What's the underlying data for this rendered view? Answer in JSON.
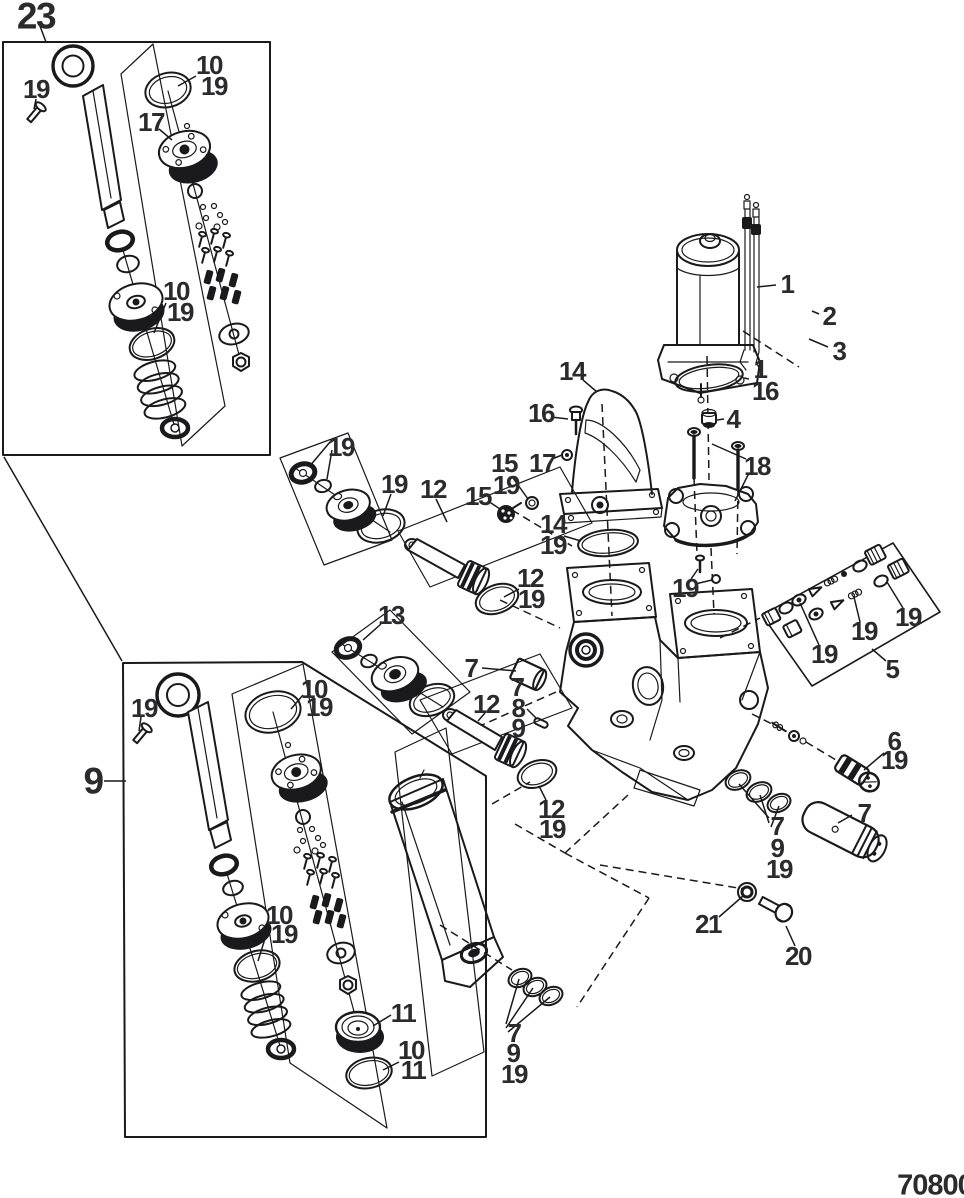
{
  "page": {
    "code": "70800",
    "type": "exploded-parts-diagram"
  },
  "colors": {
    "line": "#1a1a1c",
    "label": "#2b2b2d",
    "background": "#ffffff"
  },
  "callouts": [
    {
      "label": "23",
      "x": 36,
      "y": 16,
      "size": "lg"
    },
    {
      "label": "19",
      "x": 36,
      "y": 89,
      "size": "n"
    },
    {
      "label": "10",
      "x": 209,
      "y": 65,
      "size": "n"
    },
    {
      "label": "19",
      "x": 214,
      "y": 86,
      "size": "n"
    },
    {
      "label": "17",
      "x": 151,
      "y": 122,
      "size": "n"
    },
    {
      "label": "10",
      "x": 176,
      "y": 291,
      "size": "n"
    },
    {
      "label": "19",
      "x": 180,
      "y": 312,
      "size": "n"
    },
    {
      "label": "19",
      "x": 341,
      "y": 447,
      "size": "n"
    },
    {
      "label": "19",
      "x": 394,
      "y": 484,
      "size": "n"
    },
    {
      "label": "12",
      "x": 433,
      "y": 489,
      "size": "n"
    },
    {
      "label": "15",
      "x": 504,
      "y": 463,
      "size": "n"
    },
    {
      "label": "19",
      "x": 506,
      "y": 485,
      "size": "n"
    },
    {
      "label": "15",
      "x": 478,
      "y": 496,
      "size": "n"
    },
    {
      "label": "14",
      "x": 572,
      "y": 371,
      "size": "n"
    },
    {
      "label": "16",
      "x": 541,
      "y": 413,
      "size": "n"
    },
    {
      "label": "17",
      "x": 542,
      "y": 463,
      "size": "n"
    },
    {
      "label": "14",
      "x": 553,
      "y": 524,
      "size": "n"
    },
    {
      "label": "19",
      "x": 553,
      "y": 545,
      "size": "n"
    },
    {
      "label": "12",
      "x": 530,
      "y": 578,
      "size": "n"
    },
    {
      "label": "19",
      "x": 531,
      "y": 599,
      "size": "n"
    },
    {
      "label": "1",
      "x": 787,
      "y": 284,
      "size": "n"
    },
    {
      "label": "2",
      "x": 829,
      "y": 316,
      "size": "n"
    },
    {
      "label": "3",
      "x": 839,
      "y": 351,
      "size": "n"
    },
    {
      "label": "1",
      "x": 760,
      "y": 369,
      "size": "n"
    },
    {
      "label": "16",
      "x": 765,
      "y": 391,
      "size": "n"
    },
    {
      "label": "4",
      "x": 733,
      "y": 419,
      "size": "n"
    },
    {
      "label": "18",
      "x": 757,
      "y": 466,
      "size": "n"
    },
    {
      "label": "19",
      "x": 685,
      "y": 588,
      "size": "n"
    },
    {
      "label": "19",
      "x": 824,
      "y": 654,
      "size": "n"
    },
    {
      "label": "19",
      "x": 864,
      "y": 631,
      "size": "n"
    },
    {
      "label": "19",
      "x": 908,
      "y": 617,
      "size": "n"
    },
    {
      "label": "5",
      "x": 892,
      "y": 669,
      "size": "n"
    },
    {
      "label": "6",
      "x": 894,
      "y": 741,
      "size": "n"
    },
    {
      "label": "19",
      "x": 894,
      "y": 760,
      "size": "n"
    },
    {
      "label": "7",
      "x": 471,
      "y": 668,
      "size": "n"
    },
    {
      "label": "7",
      "x": 517,
      "y": 687,
      "size": "n"
    },
    {
      "label": "8",
      "x": 518,
      "y": 708,
      "size": "n"
    },
    {
      "label": "9",
      "x": 518,
      "y": 728,
      "size": "n"
    },
    {
      "label": "12",
      "x": 486,
      "y": 704,
      "size": "n"
    },
    {
      "label": "13",
      "x": 391,
      "y": 615,
      "size": "n"
    },
    {
      "label": "12",
      "x": 551,
      "y": 809,
      "size": "n"
    },
    {
      "label": "19",
      "x": 552,
      "y": 829,
      "size": "n"
    },
    {
      "label": "7",
      "x": 777,
      "y": 826,
      "size": "n"
    },
    {
      "label": "9",
      "x": 777,
      "y": 848,
      "size": "n"
    },
    {
      "label": "19",
      "x": 779,
      "y": 869,
      "size": "n"
    },
    {
      "label": "7",
      "x": 864,
      "y": 813,
      "size": "n"
    },
    {
      "label": "21",
      "x": 708,
      "y": 924,
      "size": "n"
    },
    {
      "label": "20",
      "x": 798,
      "y": 956,
      "size": "n"
    },
    {
      "label": "9",
      "x": 93,
      "y": 781,
      "size": "lg"
    },
    {
      "label": "19",
      "x": 144,
      "y": 708,
      "size": "n"
    },
    {
      "label": "10",
      "x": 314,
      "y": 689,
      "size": "n"
    },
    {
      "label": "19",
      "x": 319,
      "y": 707,
      "size": "n"
    },
    {
      "label": "10",
      "x": 279,
      "y": 915,
      "size": "n"
    },
    {
      "label": "19",
      "x": 284,
      "y": 934,
      "size": "n"
    },
    {
      "label": "11",
      "x": 403,
      "y": 1013,
      "size": "n"
    },
    {
      "label": "10",
      "x": 411,
      "y": 1050,
      "size": "n"
    },
    {
      "label": "11",
      "x": 413,
      "y": 1070,
      "size": "n"
    },
    {
      "label": "7",
      "x": 514,
      "y": 1033,
      "size": "n"
    },
    {
      "label": "9",
      "x": 513,
      "y": 1053,
      "size": "n"
    },
    {
      "label": "19",
      "x": 514,
      "y": 1074,
      "size": "n"
    }
  ]
}
